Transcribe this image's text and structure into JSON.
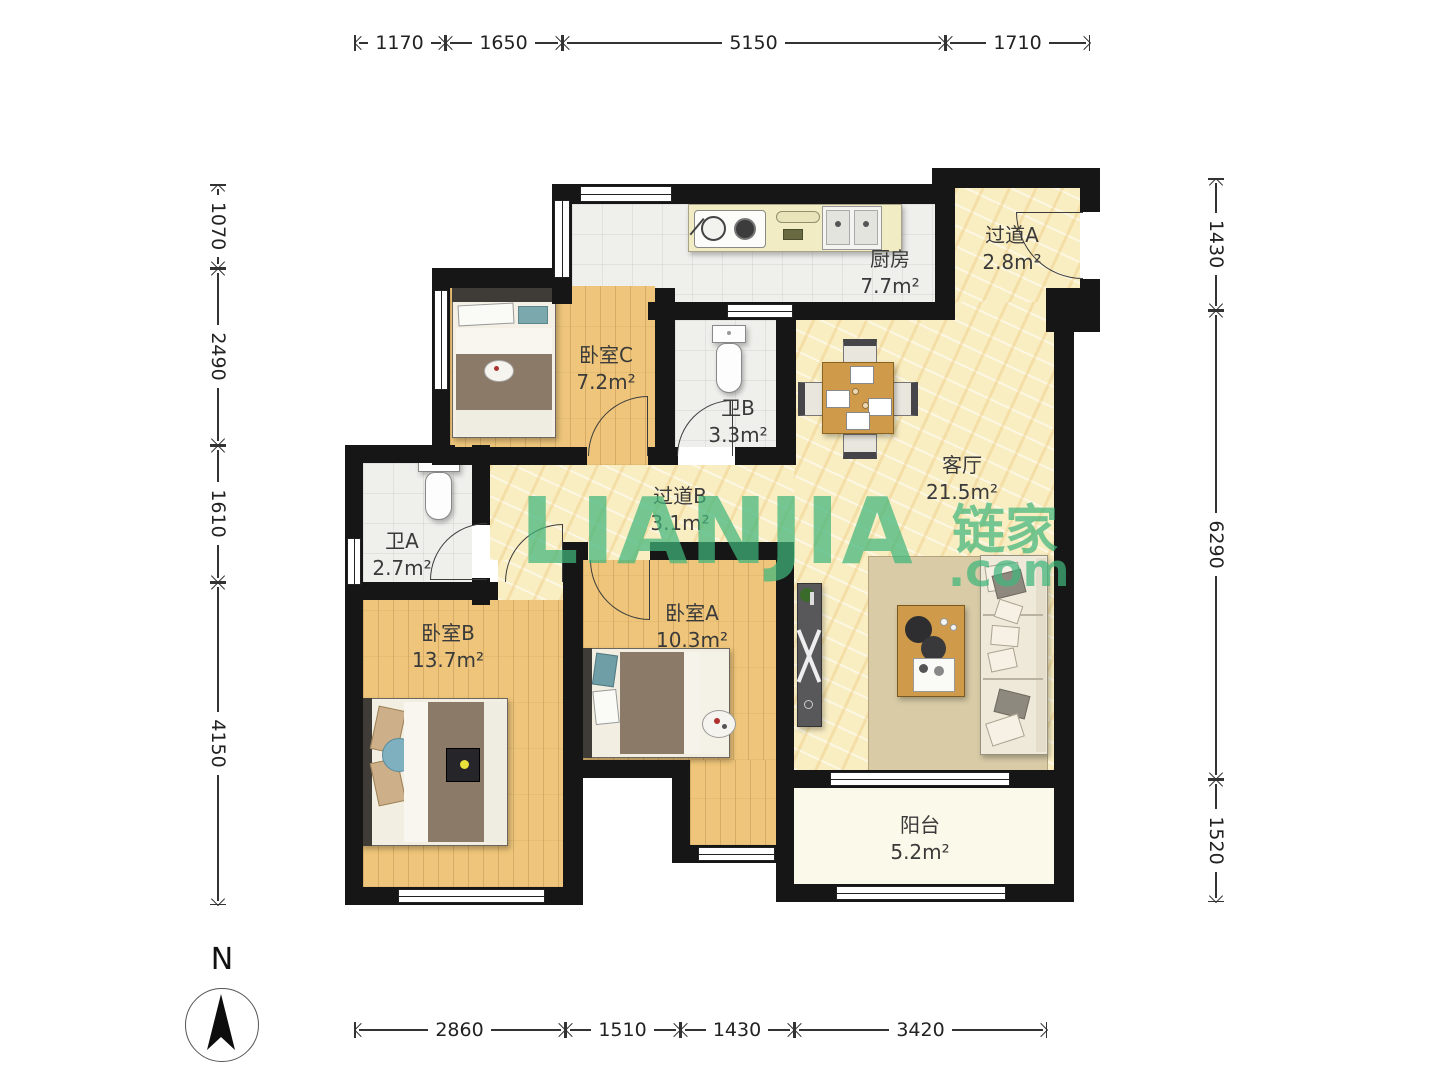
{
  "compass": {
    "label": "N"
  },
  "watermark": {
    "brand": "LIANJIA",
    "brand_cn": "链家",
    "suffix": ".com",
    "color": "#40b57c"
  },
  "rooms": {
    "kitchen": {
      "name": "厨房",
      "area": "7.7m²"
    },
    "hallway_a": {
      "name": "过道A",
      "area": "2.8m²"
    },
    "bedroom_c": {
      "name": "卧室C",
      "area": "7.2m²"
    },
    "bath_b": {
      "name": "卫B",
      "area": "3.3m²"
    },
    "living": {
      "name": "客厅",
      "area": "21.5m²"
    },
    "hallway_b": {
      "name": "过道B",
      "area": "3.1m²"
    },
    "bath_a": {
      "name": "卫A",
      "area": "2.7m²"
    },
    "bedroom_b": {
      "name": "卧室B",
      "area": "13.7m²"
    },
    "bedroom_a": {
      "name": "卧室A",
      "area": "10.3m²"
    },
    "balcony": {
      "name": "阳台",
      "area": "5.2m²"
    }
  },
  "dimensions": {
    "top": [
      "1170",
      "1650",
      "5150",
      "1710"
    ],
    "bottom": [
      "2860",
      "1510",
      "1430",
      "3420"
    ],
    "left": [
      "1070",
      "2490",
      "1610",
      "4150"
    ],
    "right": [
      "1430",
      "6290",
      "1520"
    ]
  }
}
